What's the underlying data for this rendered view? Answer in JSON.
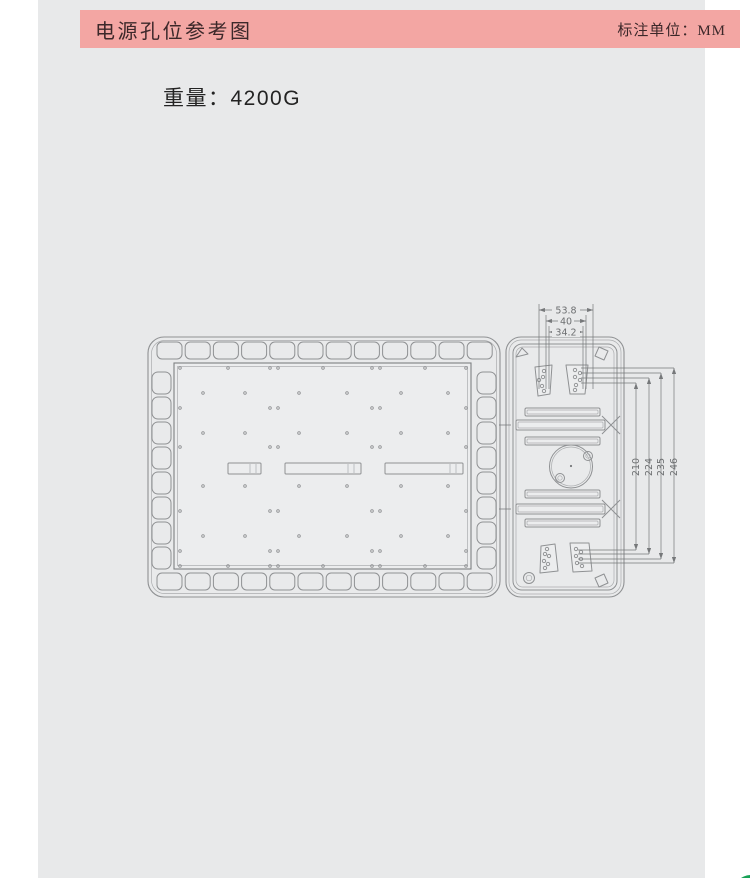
{
  "header": {
    "title": "电源孔位参考图",
    "unit_label": "标注单位：MM"
  },
  "weight_label": "重量：4200G",
  "colors": {
    "header_bg": "#f3a6a3",
    "header_text": "#3c282a",
    "page_bg": "#e8e9ea",
    "outer_bg": "#ffffff",
    "drawing_line": "#8f9193",
    "dimension": "#76787a",
    "green_button": "#18a257"
  },
  "drawing": {
    "top_dims": [
      {
        "label": "53.8",
        "x1": 406,
        "x2": 460,
        "y": 20
      },
      {
        "label": "40",
        "x1": 413,
        "x2": 453,
        "y": 31
      },
      {
        "label": "34.2",
        "x1": 416,
        "x2": 450,
        "y": 42
      }
    ],
    "right_dims": [
      {
        "label": "210",
        "x": 503,
        "y1": 93,
        "y2": 260
      },
      {
        "label": "224",
        "x": 516,
        "y1": 88,
        "y2": 264
      },
      {
        "label": "235",
        "x": 528,
        "y1": 83,
        "y2": 269
      },
      {
        "label": "246",
        "x": 541,
        "y1": 78,
        "y2": 273
      }
    ],
    "vent_slots": {
      "top_row": {
        "count": 12,
        "x0": 24,
        "y": 52,
        "w": 25,
        "h": 17,
        "step": 28.2,
        "rx": 5
      },
      "bottom_row": {
        "count": 12,
        "x0": 24,
        "y": 283,
        "w": 25,
        "h": 17,
        "step": 28.2,
        "rx": 5
      },
      "left_col": {
        "count": 8,
        "x": 19,
        "y0": 82,
        "w": 19,
        "h": 22,
        "step": 25,
        "rx": 6
      },
      "right_col": {
        "count": 8,
        "x": 344,
        "y0": 82,
        "w": 19,
        "h": 22,
        "step": 25,
        "rx": 6
      }
    },
    "panel_holes": [
      [
        47,
        78
      ],
      [
        95,
        78
      ],
      [
        137,
        78
      ],
      [
        145,
        78
      ],
      [
        190,
        78
      ],
      [
        239,
        78
      ],
      [
        247,
        78
      ],
      [
        292,
        78
      ],
      [
        333,
        78
      ],
      [
        70,
        103
      ],
      [
        112,
        103
      ],
      [
        166,
        103
      ],
      [
        214,
        103
      ],
      [
        268,
        103
      ],
      [
        315,
        103
      ],
      [
        47,
        118
      ],
      [
        137,
        118
      ],
      [
        145,
        118
      ],
      [
        239,
        118
      ],
      [
        247,
        118
      ],
      [
        333,
        118
      ],
      [
        70,
        143
      ],
      [
        112,
        143
      ],
      [
        166,
        143
      ],
      [
        214,
        143
      ],
      [
        268,
        143
      ],
      [
        315,
        143
      ],
      [
        47,
        157
      ],
      [
        137,
        157
      ],
      [
        145,
        157
      ],
      [
        239,
        157
      ],
      [
        247,
        157
      ],
      [
        333,
        157
      ],
      [
        70,
        196
      ],
      [
        112,
        196
      ],
      [
        166,
        196
      ],
      [
        214,
        196
      ],
      [
        268,
        196
      ],
      [
        315,
        196
      ],
      [
        47,
        221
      ],
      [
        137,
        221
      ],
      [
        145,
        221
      ],
      [
        239,
        221
      ],
      [
        247,
        221
      ],
      [
        333,
        221
      ],
      [
        70,
        246
      ],
      [
        112,
        246
      ],
      [
        166,
        246
      ],
      [
        214,
        246
      ],
      [
        268,
        246
      ],
      [
        315,
        246
      ],
      [
        47,
        261
      ],
      [
        137,
        261
      ],
      [
        145,
        261
      ],
      [
        239,
        261
      ],
      [
        247,
        261
      ],
      [
        333,
        261
      ],
      [
        47,
        276
      ],
      [
        95,
        276
      ],
      [
        137,
        276
      ],
      [
        145,
        276
      ],
      [
        190,
        276
      ],
      [
        239,
        276
      ],
      [
        247,
        276
      ],
      [
        292,
        276
      ],
      [
        333,
        276
      ]
    ],
    "trap_holes": [
      [
        411,
        81
      ],
      [
        410,
        87
      ],
      [
        406,
        90
      ],
      [
        409,
        96
      ],
      [
        411,
        101
      ],
      [
        442,
        80
      ],
      [
        447,
        83
      ],
      [
        442,
        87
      ],
      [
        447,
        90
      ],
      [
        443,
        95
      ],
      [
        442,
        100
      ],
      [
        414,
        259
      ],
      [
        412,
        264
      ],
      [
        416,
        266
      ],
      [
        411,
        271
      ],
      [
        415,
        274
      ],
      [
        412,
        278
      ],
      [
        443,
        259
      ],
      [
        448,
        262
      ],
      [
        443,
        266
      ],
      [
        448,
        269
      ],
      [
        444,
        273
      ],
      [
        449,
        276
      ]
    ]
  }
}
